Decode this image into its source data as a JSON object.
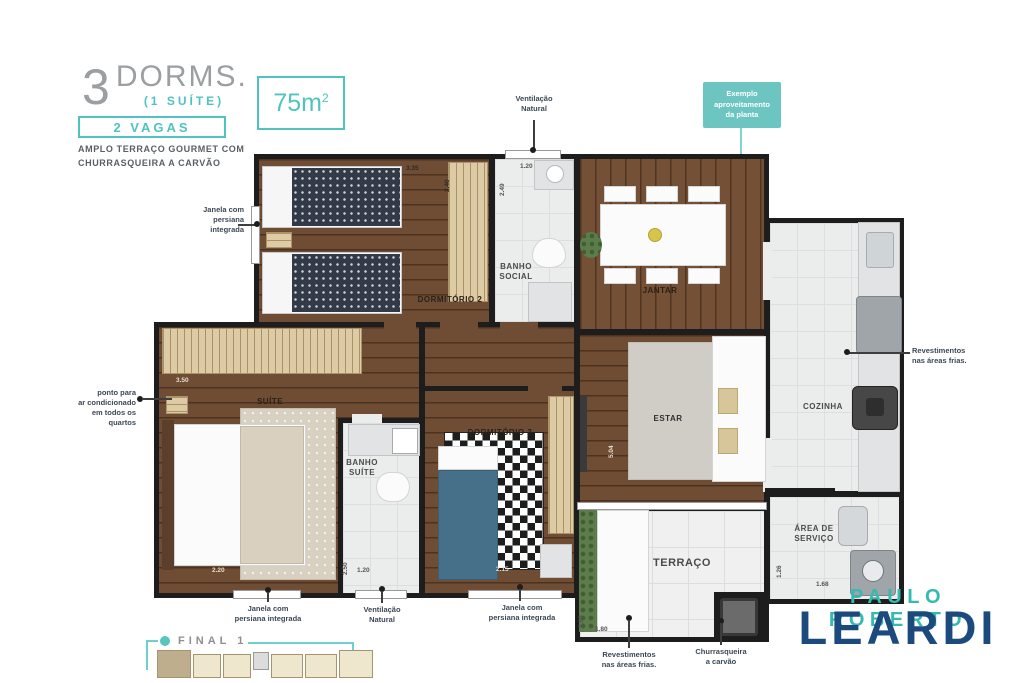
{
  "colors": {
    "teal_accent": "#4fc4bf",
    "navy_brand": "#1b4b7e",
    "wall": "#1d1d1d",
    "wood_floor": "#6f4c34",
    "tile_floor": "#ebecec"
  },
  "header": {
    "big_number": "3",
    "title": "DORMS.",
    "suite_note": "(1 SUÍTE)",
    "vagas_label": "2 VAGAS",
    "tagline_line1": "AMPLO TERRAÇO GOURMET COM",
    "tagline_line2": "CHURRASQUEIRA A CARVÃO"
  },
  "area_badge": {
    "value": "75m",
    "superscript": "2"
  },
  "plan_note": {
    "line1": "Exemplo",
    "line2": "aproveitamento",
    "line3": "da planta"
  },
  "callouts": {
    "vent_top": {
      "line1": "Ventilação",
      "line2": "Natural"
    },
    "janela_left": {
      "line1": "Janela com",
      "line2": "persiana",
      "line3": "integrada"
    },
    "ar_condicionado": {
      "line1": "ponto para",
      "line2": "ar condicionado",
      "line3": "em todos os",
      "line4": "quartos"
    },
    "revestimentos_right": {
      "line1": "Revestimentos",
      "line2": "nas áreas frias."
    },
    "janela_suite": {
      "line1": "Janela com",
      "line2": "persiana integrada"
    },
    "vent_bottom": {
      "line1": "Ventilação",
      "line2": "Natural"
    },
    "janela_dorm3": {
      "line1": "Janela com",
      "line2": "persiana integrada"
    },
    "revestimentos_bottom": {
      "line1": "Revestimentos",
      "line2": "nas áreas frias."
    },
    "churrasqueira": {
      "line1": "Churrasqueira",
      "line2": "a carvão"
    }
  },
  "rooms": {
    "dorm2": {
      "label": "DORMITÓRIO 2"
    },
    "banho_social": {
      "label_line1": "BANHO",
      "label_line2": "SOCIAL"
    },
    "jantar": {
      "label": "JANTAR"
    },
    "cozinha": {
      "label": "COZINHA"
    },
    "estar": {
      "label": "ESTAR"
    },
    "suite": {
      "label": "SUÍTE"
    },
    "banho_suite": {
      "label_line1": "BANHO",
      "label_line2": "SUÍTE"
    },
    "dorm3": {
      "label": "DORMITÓRIO 3"
    },
    "terraco": {
      "label": "TERRAÇO"
    },
    "area_servico": {
      "label_line1": "ÁREA DE",
      "label_line2": "SERVIÇO"
    }
  },
  "dims": {
    "dorm2_w": "3.35",
    "dorm2_h": "2.40",
    "banho_social_w": "1.20",
    "banho_social_h": "2.49",
    "suite_w": "3.50",
    "suite_bottom": "2.20",
    "banho_suite_h": "2.50",
    "banho_suite_w": "1.20",
    "dorm3_w": "2.15",
    "estar_h": "5.04",
    "terraco_h": "2.80",
    "terraco_w": "1.80",
    "servico_h": "1.26",
    "servico_w": "1.68"
  },
  "keyplan": {
    "label": "FINAL 1"
  },
  "brand": {
    "line1": "PAULO ROBERTO",
    "line2": "LEARDI"
  }
}
